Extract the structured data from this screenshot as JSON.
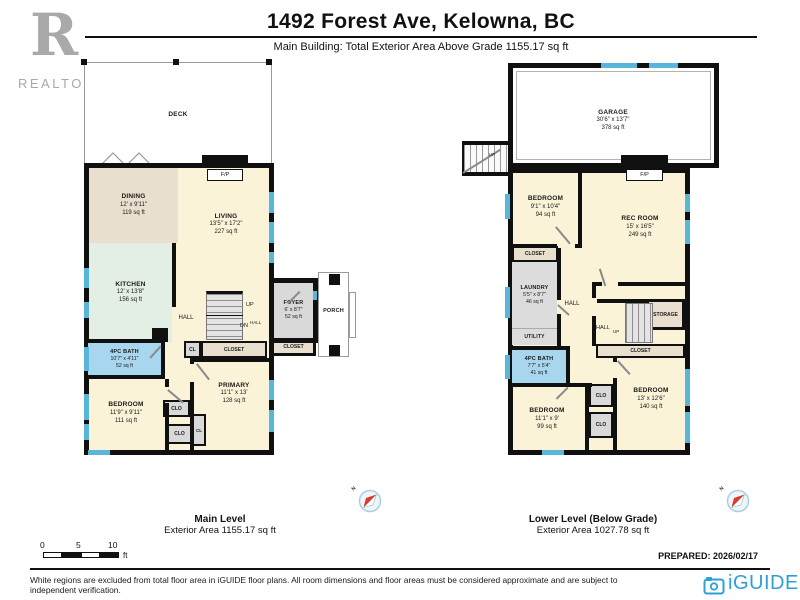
{
  "header": {
    "title": "1492 Forest Ave, Kelowna, BC",
    "subtitle": "Main Building: Total Exterior Area Above Grade 1155.17 sq ft",
    "realtor_r": "R",
    "realtor_wordmark": "REALTOR®"
  },
  "main_level": {
    "caption": "Main Level",
    "caption_area": "Exterior Area 1155.17 sq ft",
    "compass_n": "N",
    "deck": {
      "name": "DECK"
    },
    "dining": {
      "name": "DINING",
      "dims": "12' x 9'11\"",
      "area": "119 sq ft"
    },
    "living": {
      "name": "LIVING",
      "dims": "13'5\" x 17'2\"",
      "area": "227 sq ft"
    },
    "kitchen": {
      "name": "KITCHEN",
      "dims": "12' x 13'8\"",
      "area": "156 sq ft"
    },
    "hall": "HALL",
    "stairs_up": "UP",
    "stairs_dn": "DN",
    "stairs_dn_hall": "HALL",
    "fireplace": "F/P",
    "foyer": {
      "name": "FOYER",
      "dims": "6' x 8'7\"",
      "area": "52 sq ft"
    },
    "porch": {
      "name": "PORCH"
    },
    "bath": {
      "name": "4PC BATH",
      "dims": "10'7\" x 4'11\"",
      "area": "52 sq ft"
    },
    "bedroom": {
      "name": "BEDROOM",
      "dims": "11'9\" x 9'11\"",
      "area": "111 sq ft"
    },
    "primary": {
      "name": "PRIMARY",
      "dims": "11'1\" x 13'",
      "area": "128 sq ft"
    },
    "closet_hall": "CLOSET",
    "closet_foyer": "CLOSET",
    "cl": "CL",
    "cl2": "CL",
    "clo1": "CLO",
    "clo2": "CLO"
  },
  "lower_level": {
    "caption": "Lower Level (Below Grade)",
    "caption_area": "Exterior Area 1027.78 sq ft",
    "compass_n": "N",
    "garage": {
      "name": "GARAGE",
      "dims": "30'6\" x 13'7\"",
      "area": "378 sq ft"
    },
    "garage_stairs_up": "UP",
    "bedroom1": {
      "name": "BEDROOM",
      "dims": "9'1\" x 10'4\"",
      "area": "94 sq ft"
    },
    "rec_room": {
      "name": "REC ROOM",
      "dims": "15' x 16'5\"",
      "area": "249 sq ft"
    },
    "fireplace": "F/P",
    "closet_top": "CLOSET",
    "laundry": {
      "name": "LAUNDRY",
      "dims": "5'5\" x 8'7\"",
      "area": "46 sq ft"
    },
    "hall": "HALL",
    "utility": "UTILITY",
    "storage": "STORAGE",
    "stairs_hall": "HALL",
    "stairs_up": "UP",
    "closet_mid": "CLOSET",
    "bath": {
      "name": "4PC BATH",
      "dims": "7'7\" x 5'4\"",
      "area": "41 sq ft"
    },
    "bedroom2": {
      "name": "BEDROOM",
      "dims": "11'1\" x 9'",
      "area": "99 sq ft"
    },
    "bedroom3": {
      "name": "BEDROOM",
      "dims": "13' x 12'6\"",
      "area": "140 sq ft"
    },
    "clo1": "CLO",
    "clo2": "CLO"
  },
  "footer": {
    "scale_ticks": [
      "0",
      "5",
      "10"
    ],
    "scale_unit": "ft",
    "prepared": "PREPARED: 2026/02/17",
    "disclaimer": "White regions are excluded from total floor area in iGUIDE floor plans. All room dimensions and floor areas must be considered approximate and are subject to independent verification.",
    "brand": "iGUIDE"
  },
  "colors": {
    "wall": "#101010",
    "window": "#57b6da",
    "floor_cream": "#faf3d8",
    "floor_tan": "#e8dfcf",
    "floor_mint": "#e3eee5",
    "floor_bath_blue": "#a9d6ef",
    "floor_gray": "#d9d9d9",
    "brand_blue": "#2ea0d8",
    "realtor_gray": "#a9a9a9",
    "compass_red": "#d93a2b"
  }
}
